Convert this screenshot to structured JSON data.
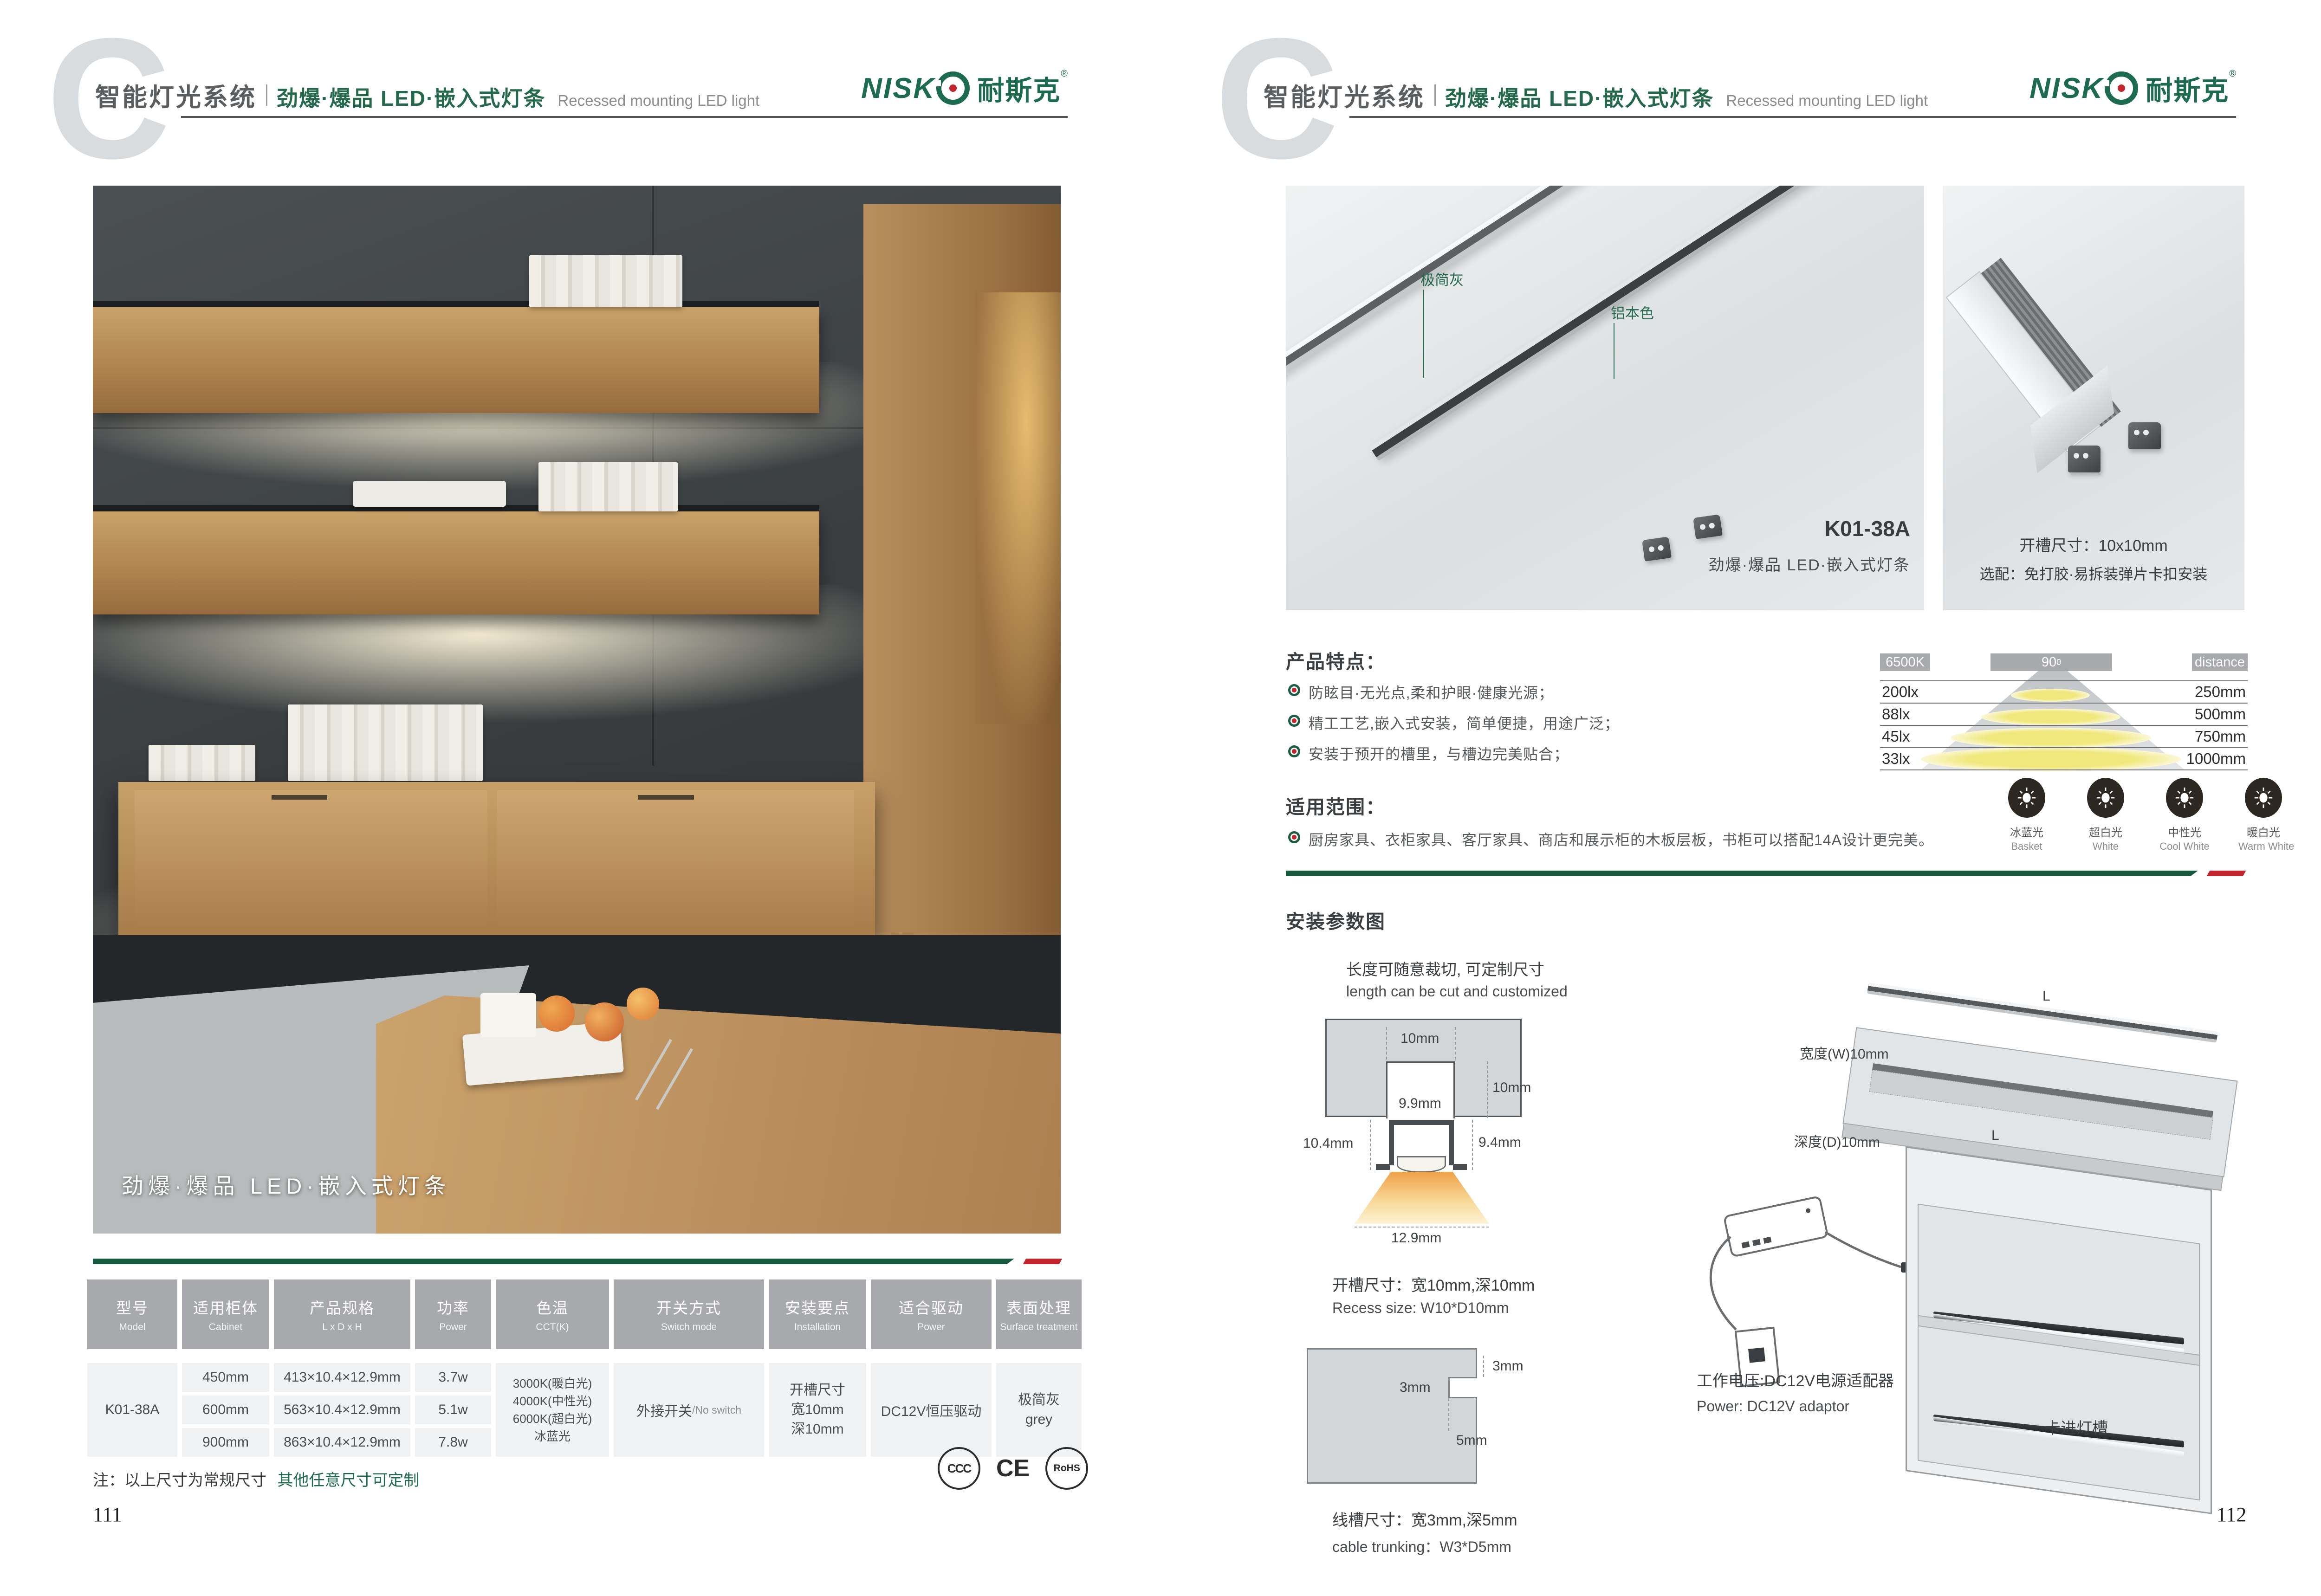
{
  "colors": {
    "brand_green": "#1c6b4e",
    "bar_green": "#17593f",
    "bar_red": "#c4242b",
    "header_grey": "#a7a9ac"
  },
  "header": {
    "section_letter": "C",
    "title_zh": "智能灯光系统",
    "subtitle_zh": "劲爆·爆品  LED·嵌入式灯条",
    "subtitle_en": "Recessed mounting LED light",
    "brand_en": "NISK",
    "brand_zh": "耐斯克",
    "brand_reg": "®"
  },
  "left_page": {
    "photo_caption": "劲爆·爆品 LED·嵌入式灯条",
    "table": {
      "headers": [
        {
          "zh": "型号",
          "en": "Model"
        },
        {
          "zh": "适用柜体",
          "en": "Cabinet"
        },
        {
          "zh": "产品规格",
          "en": "L x D x H"
        },
        {
          "zh": "功率",
          "en": "Power"
        },
        {
          "zh": "色温",
          "en": "CCT(K)"
        },
        {
          "zh": "开关方式",
          "en": "Switch mode"
        },
        {
          "zh": "安装要点",
          "en": "Installation"
        },
        {
          "zh": "适合驱动",
          "en": "Power"
        },
        {
          "zh": "表面处理",
          "en": "Surface treatment"
        }
      ],
      "model": "K01-38A",
      "rows": [
        {
          "cabinet": "450mm",
          "spec": "413×10.4×12.9mm",
          "power": "3.7w"
        },
        {
          "cabinet": "600mm",
          "spec": "563×10.4×12.9mm",
          "power": "5.1w"
        },
        {
          "cabinet": "900mm",
          "spec": "863×10.4×12.9mm",
          "power": "7.8w"
        }
      ],
      "cct_lines": [
        "3000K(暖白光)",
        "4000K(中性光)",
        "6000K(超白光)",
        "冰蓝光"
      ],
      "switch_zh": "外接开关",
      "switch_en": "/No switch",
      "install_lines": [
        "开槽尺寸",
        "宽10mm",
        "深10mm"
      ],
      "driver": "DC12V恒压驱动",
      "surface_zh": "极简灰",
      "surface_en": "grey"
    },
    "note_black": "注：以上尺寸为常规尺寸",
    "note_green": "其他任意尺寸可定制",
    "certs": [
      "CCC",
      "CE",
      "RoHS"
    ],
    "page_number": "111"
  },
  "right_page": {
    "photo_main": {
      "label_grey": "极简灰",
      "label_alu": "铝本色",
      "model": "K01-38A",
      "caption": "劲爆·爆品  LED·嵌入式灯条"
    },
    "photo_side": {
      "line1": "开槽尺寸：10x10mm",
      "line2": "选配：免打胶·易拆装弹片卡扣安装"
    },
    "features": {
      "title": "产品特点：",
      "items": [
        "防眩目·无光点,柔和护眼·健康光源；",
        "精工工艺,嵌入式安装，简单便捷，用途广泛；",
        "安装于预开的槽里，与槽边完美贴合；"
      ]
    },
    "light_chart": {
      "cct": "6500K",
      "angle": "90",
      "angle_sup": "0",
      "distance_label": "distance",
      "rows": [
        {
          "lux": "200lx",
          "distance": "250mm"
        },
        {
          "lux": "88lx",
          "distance": "500mm"
        },
        {
          "lux": "45lx",
          "distance": "750mm"
        },
        {
          "lux": "33lx",
          "distance": "1000mm"
        }
      ]
    },
    "color_temps": [
      {
        "zh": "冰蓝光",
        "en": "Basket",
        "color": "#a9d9f2"
      },
      {
        "zh": "超白光",
        "en": "White",
        "color": "#ffffff"
      },
      {
        "zh": "中性光",
        "en": "Cool White",
        "color": "#f6ecd4"
      },
      {
        "zh": "暖白光",
        "en": "Warm White",
        "color": "#f2cd7e"
      }
    ],
    "scope": {
      "title": "适用范围：",
      "item": "厨房家具、衣柜家具、客厅家具、商店和展示柜的木板层板，书柜可以搭配14A设计更完美。"
    },
    "install": {
      "title": "安装参数图",
      "cut_zh": "长度可随意裁切, 可定制尺寸",
      "cut_en": "length can be cut and customized",
      "cross": {
        "top": "10mm",
        "depth": "10mm",
        "slot": "9.9mm",
        "left": "10.4mm",
        "right": "9.4mm",
        "bottom": "12.9mm"
      },
      "recess_zh": "开槽尺寸：宽10mm,深10mm",
      "recess_en": "Recess size: W10*D10mm",
      "notch": {
        "a": "3mm",
        "b": "3mm",
        "c": "5mm"
      },
      "trunk_zh": "线槽尺寸：宽3mm,深5mm",
      "trunk_en": "cable trunking：W3*D5mm",
      "board": {
        "strip_len": "L",
        "width": "宽度(W)10mm",
        "groove_len": "L",
        "depth": "深度(D)10mm",
        "caption": "建议开槽尺寸"
      },
      "power_zh": "工作电压:DC12V电源适配器",
      "power_en": "Power: DC12V adaptor",
      "clip_label": "卡进灯槽"
    },
    "page_number": "112"
  }
}
